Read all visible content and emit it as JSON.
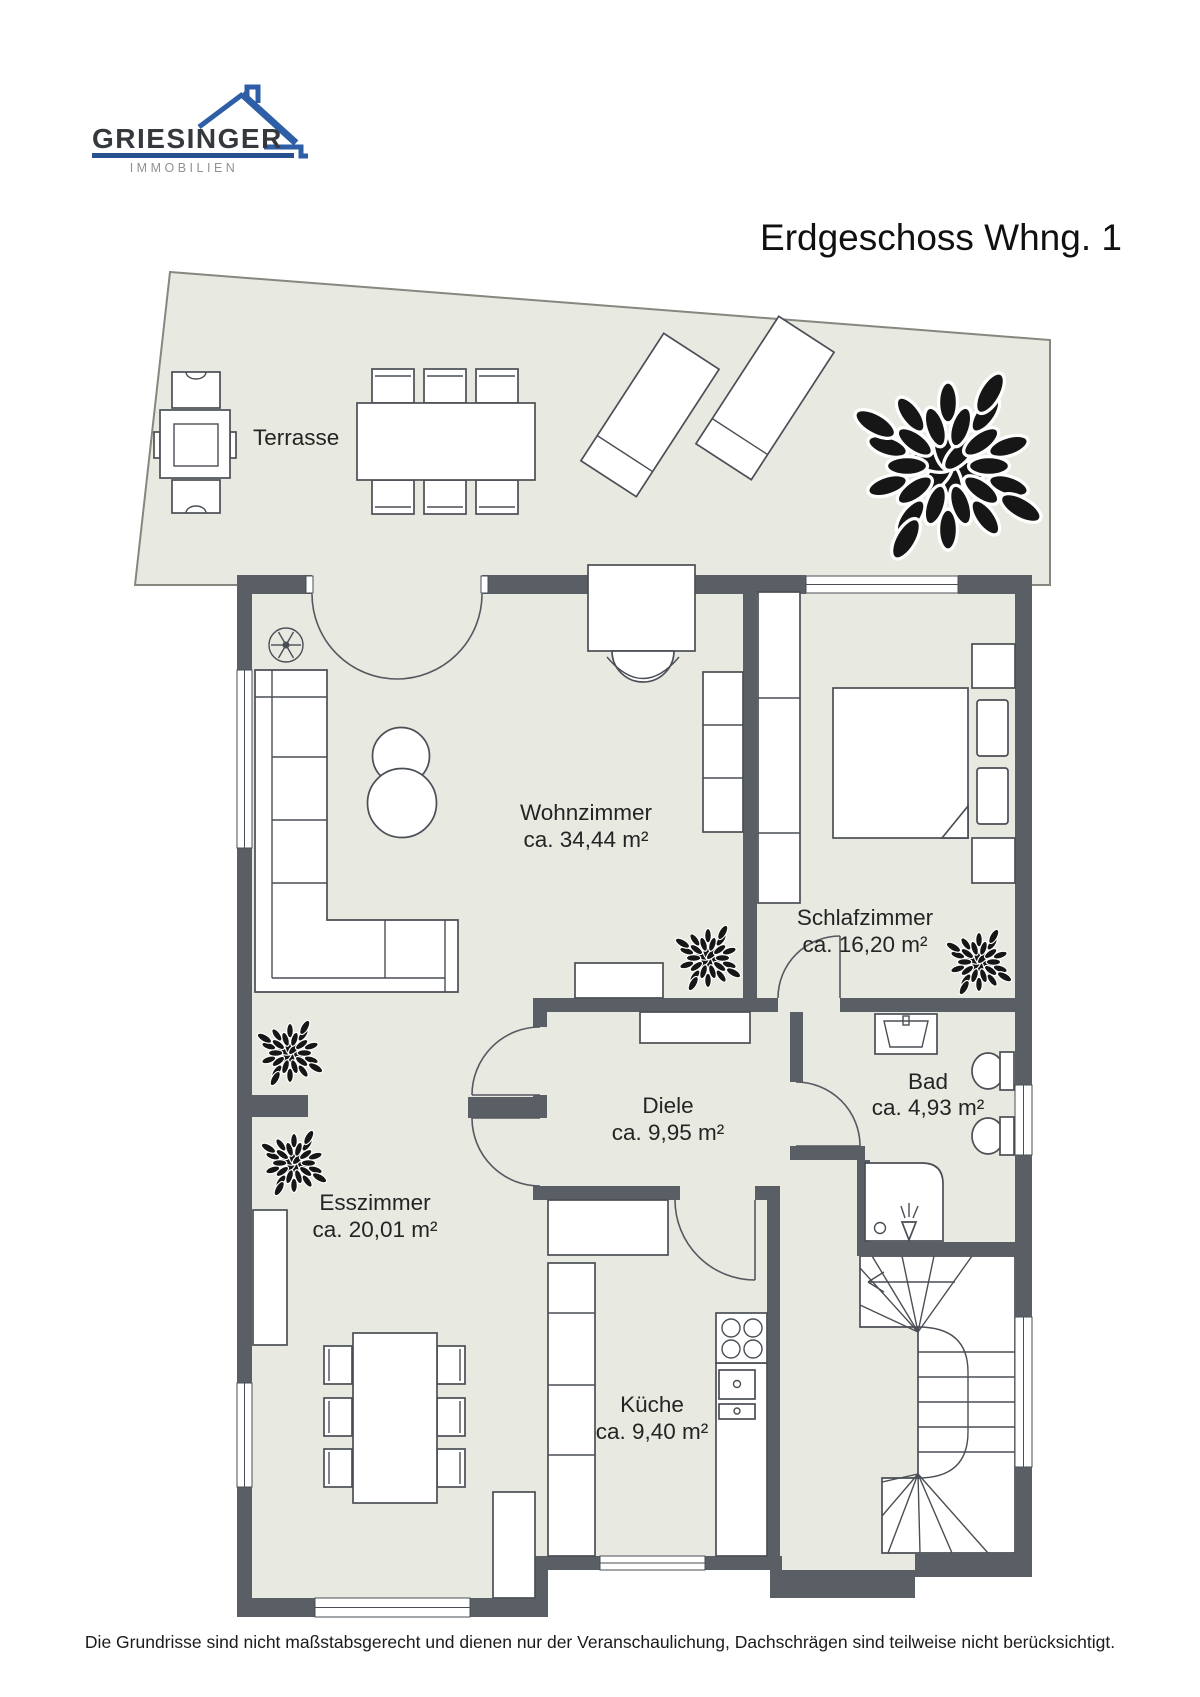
{
  "brand": {
    "name": "GRIESINGER",
    "division": "IMMOBILIEN"
  },
  "title": "Erdgeschoss Whng. 1",
  "floor_plan": {
    "rooms": [
      {
        "id": "terrasse",
        "label": "Terrasse",
        "area": ""
      },
      {
        "id": "wohnzimmer",
        "label": "Wohnzimmer",
        "area": "ca. 34,44 m²"
      },
      {
        "id": "schlafzimmer",
        "label": "Schlafzimmer",
        "area": "ca. 16,20 m²"
      },
      {
        "id": "bad",
        "label": "Bad",
        "area": "ca. 4,93 m²"
      },
      {
        "id": "diele",
        "label": "Diele",
        "area": "ca. 9,95 m²"
      },
      {
        "id": "esszimmer",
        "label": "Esszimmer",
        "area": "ca. 20,01 m²"
      },
      {
        "id": "kueche",
        "label": "Küche",
        "area": "ca. 9,40 m²"
      }
    ]
  },
  "disclaimer": "Die Grundrisse sind nicht maßstabsgerecht und dienen nur der Veranschaulichung, Dachschrägen sind teilweise nicht berücksichtigt.",
  "colors": {
    "wall": "#5a5f66",
    "floor": "#e8e9e1",
    "brand_blue": "#2e5ea6",
    "text": "#242424"
  }
}
